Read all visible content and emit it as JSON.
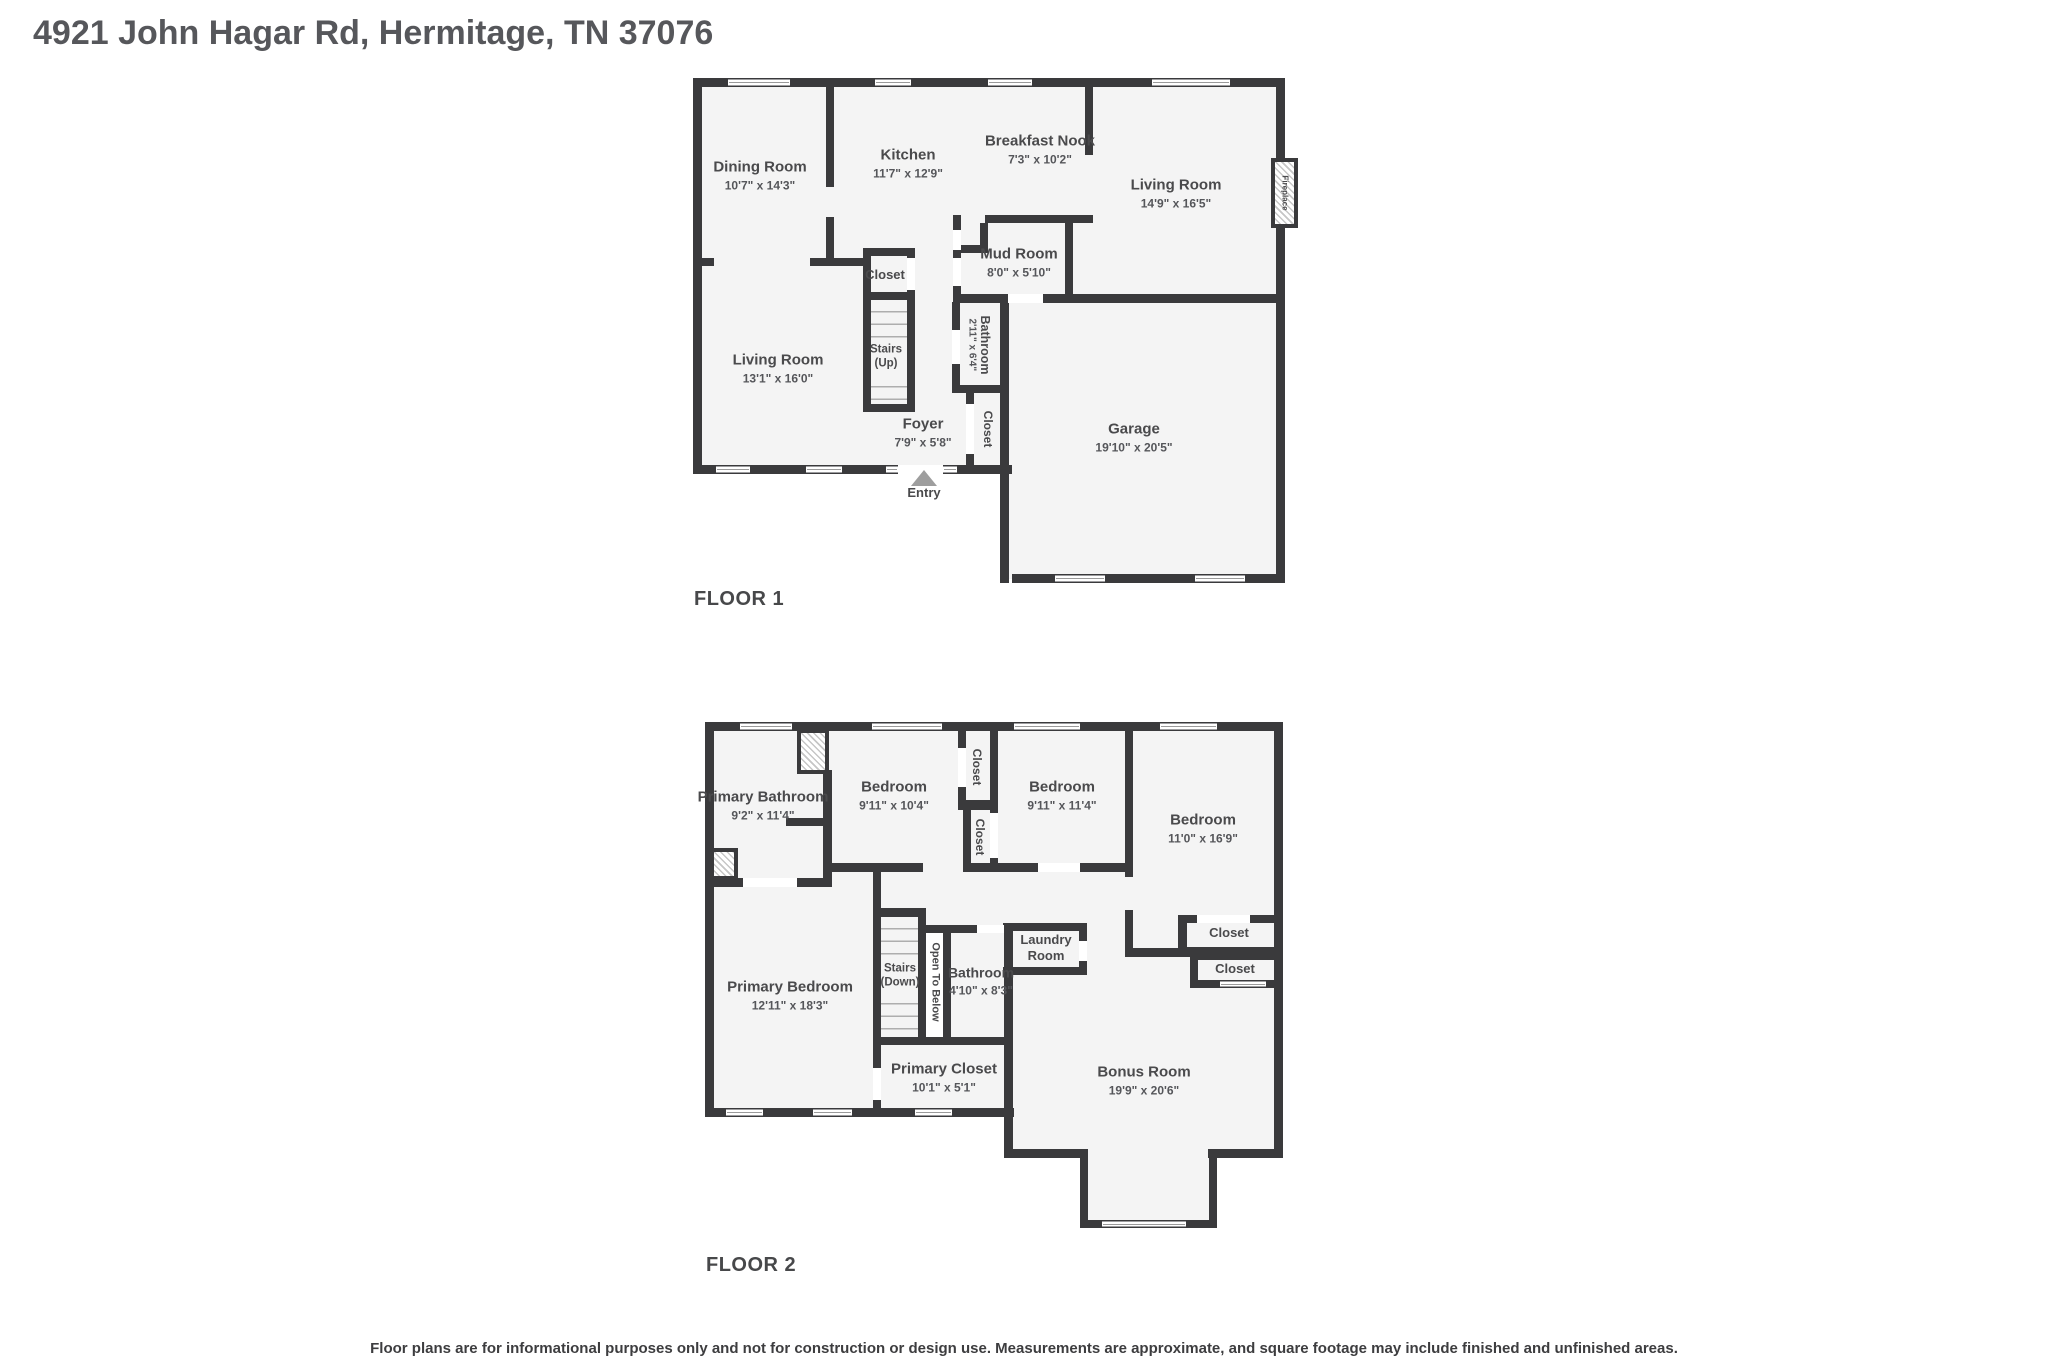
{
  "title": "4921 John Hagar Rd, Hermitage, TN 37076",
  "disclaimer": "Floor plans are for informational purposes only and not for construction or design use. Measurements are approximate, and square footage may include finished and unfinished areas.",
  "colors": {
    "wall": "#3a3a3c",
    "room_fill": "#f4f4f4",
    "label_text": "#4a4a4c",
    "entry_marker": "#9e9e9e"
  },
  "floor1": {
    "label": "FLOOR 1",
    "rooms": {
      "dining": {
        "name": "Dining Room",
        "dims": "10'7\" x 14'3\""
      },
      "kitchen": {
        "name": "Kitchen",
        "dims": "11'7\" x 12'9\""
      },
      "breakfast_nook": {
        "name": "Breakfast Nook",
        "dims": "7'3\" x 10'2\""
      },
      "living_room_upper": {
        "name": "Living Room",
        "dims": "14'9\" x 16'5\""
      },
      "living_room_lower": {
        "name": "Living Room",
        "dims": "13'1\" x 16'0\""
      },
      "mud_room": {
        "name": "Mud Room",
        "dims": "8'0\" x 5'10\""
      },
      "stair_closet": {
        "name": "Closet"
      },
      "stairs": {
        "name": "Stairs (Up)"
      },
      "bathroom": {
        "name": "Bathroom",
        "dims": "2'11\" x 6'4\""
      },
      "foyer": {
        "name": "Foyer",
        "dims": "7'9\" x 5'8\""
      },
      "foyer_closet": {
        "name": "Closet"
      },
      "garage": {
        "name": "Garage",
        "dims": "19'10\" x 20'5\""
      },
      "fireplace": {
        "name": "Fireplace"
      },
      "entry": {
        "name": "Entry"
      }
    }
  },
  "floor2": {
    "label": "FLOOR 2",
    "rooms": {
      "primary_bathroom": {
        "name": "Primary Bathroom",
        "dims": "9'2\" x 11'4\""
      },
      "bedroom_1": {
        "name": "Bedroom",
        "dims": "9'11\" x 10'4\""
      },
      "bedroom_2": {
        "name": "Bedroom",
        "dims": "9'11\" x 11'4\""
      },
      "bedroom_3": {
        "name": "Bedroom",
        "dims": "11'0\" x 16'9\""
      },
      "closet_1": {
        "name": "Closet"
      },
      "closet_2": {
        "name": "Closet"
      },
      "closet_3": {
        "name": "Closet"
      },
      "closet_4": {
        "name": "Closet"
      },
      "primary_bedroom": {
        "name": "Primary Bedroom",
        "dims": "12'11\" x 18'3\""
      },
      "stairs": {
        "name": "Stairs (Down)"
      },
      "open_to_below": {
        "name": "Open To Below"
      },
      "bathroom": {
        "name": "Bathroom",
        "dims": "4'10\" x 8'3\""
      },
      "laundry_room": {
        "name": "Laundry Room"
      },
      "primary_closet": {
        "name": "Primary Closet",
        "dims": "10'1\" x 5'1\""
      },
      "bonus_room": {
        "name": "Bonus Room",
        "dims": "19'9\" x 20'6\""
      }
    }
  }
}
